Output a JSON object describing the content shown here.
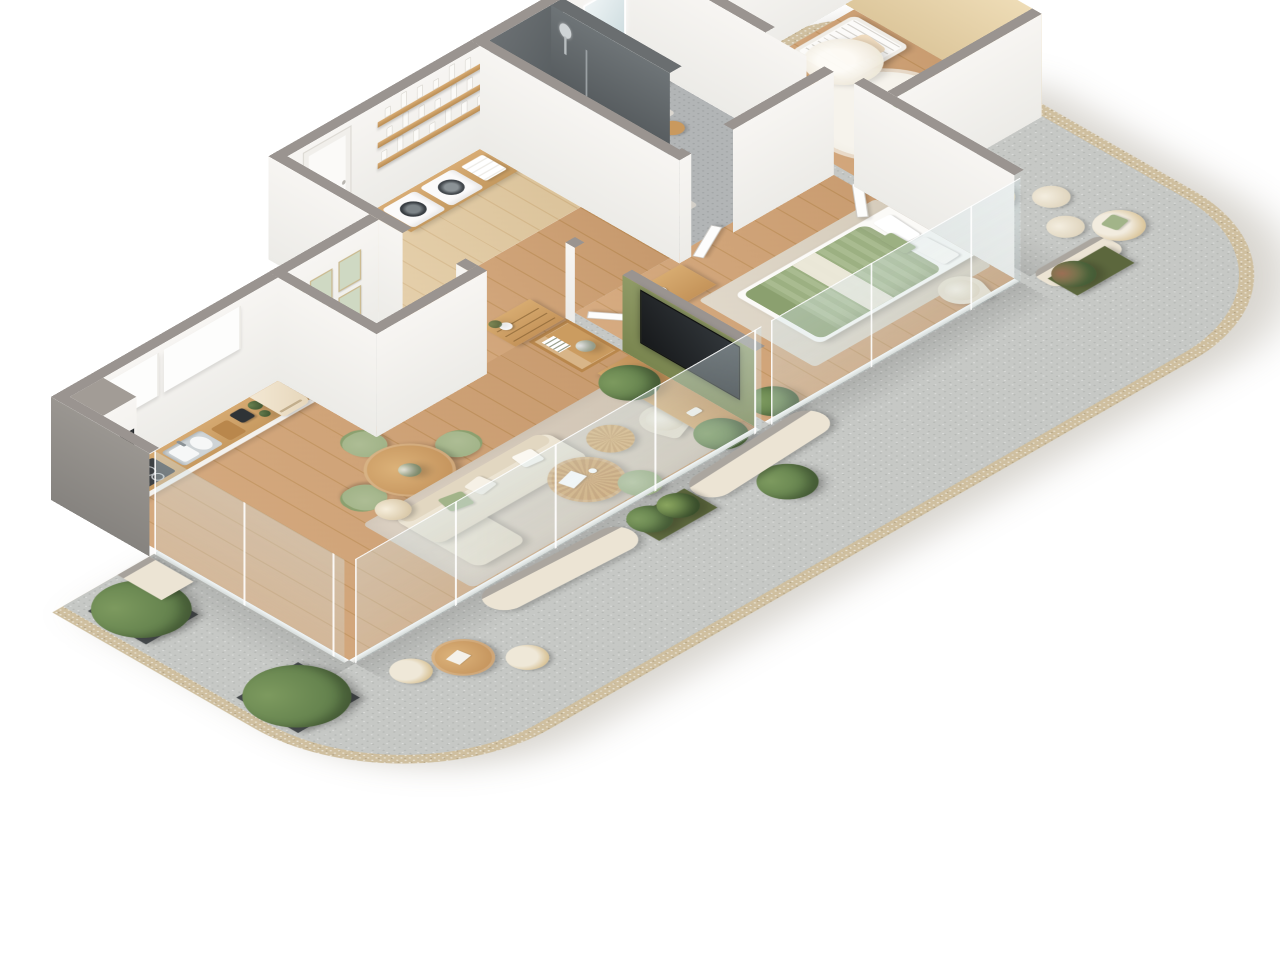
{
  "meta": {
    "type": "isometric-floorplan-render",
    "style": "scandinavian-apartment",
    "background": "#ffffff"
  },
  "colors": {
    "wall_top": "#9a9490",
    "wall_face": "#f7f5f2",
    "wall_shade": "#ecebe7",
    "wood_floor": "#d2a273",
    "wood_floor_dark": "#c4935c",
    "wood_pale": "#e4cba1",
    "wood_pale_dark": "#d9bb8c",
    "wood_counter": "#cda26c",
    "wood_furn": "#c9995e",
    "wood_furn_dark": "#b9874c",
    "dark_wall": "#5f6467",
    "dark_wall_light": "#71777a",
    "concrete": "#c6c8c5",
    "concrete_dark": "#b2b5b6",
    "railing": "#cfbf9f",
    "railing_dark": "#bfae8c",
    "cream": "#ede5d5",
    "cream_dark": "#ddd2bd",
    "sage": "#a2b489",
    "sage_dark": "#8ba06f",
    "olive": "#87925f",
    "beige_wall": "#e9d6ae",
    "plant": "#5f7d4a",
    "plant_light": "#7d9a5f",
    "planter_dark": "#45494b",
    "planter_olive": "#5c673d",
    "tan": "#d8c193",
    "glassc": "#cbdde1",
    "appl_dark": "#3c4043",
    "rug": "#d6cabb",
    "rug2": "#ddd5c7"
  },
  "apartment": {
    "rooms": [
      {
        "id": "entry",
        "furniture": [
          "front-door"
        ]
      },
      {
        "id": "laundry",
        "furniture": [
          "washer",
          "dryer",
          "wood-counter",
          "towel-stack",
          "wall-shelves-with-bottles"
        ]
      },
      {
        "id": "bathroom",
        "furniture": [
          "walk-in-shower",
          "glass-screen",
          "rain-shower-head",
          "slatted-cabinet",
          "vanity-with-basin",
          "led-mirror",
          "stool",
          "bath-mats"
        ]
      },
      {
        "id": "wc",
        "furniture": [
          "wall-hung-toilet",
          "gallery-frames",
          "magazine-ledge",
          "mat"
        ]
      },
      {
        "id": "kitchen",
        "furniture": [
          "tall-oven-column",
          "induction-cooktop",
          "double-sink",
          "cutting-board",
          "coffee-machine",
          "herb-pots",
          "retro-fridge",
          "upper-cabinets"
        ]
      },
      {
        "id": "dining",
        "furniture": [
          "round-table",
          "flower-vase",
          "sage-chairs"
        ]
      },
      {
        "id": "living-room",
        "furniture": [
          "corner-sofa",
          "sage-pillow",
          "dome-floor-lamp",
          "round-coffee-table-large",
          "round-coffee-table-small",
          "sage-pouf",
          "swivel-armchair",
          "area-rug",
          "tv-sideboard",
          "shelf-cube",
          "palm-plant",
          "monstera-plant"
        ]
      },
      {
        "id": "hallway",
        "furniture": [
          "chest-of-drawers",
          "vase"
        ]
      },
      {
        "id": "master-bedroom",
        "furniture": [
          "double-bed-sage-bedding",
          "pillows",
          "area-rug",
          "standing-mirror",
          "dresser",
          "armchair",
          "olive-tv-partition",
          "wall-tv",
          "plant"
        ]
      },
      {
        "id": "nursery",
        "furniture": [
          "crib-with-canopy",
          "round-shag-rug",
          "tripod-floor-lamp",
          "desk",
          "chair",
          "toys"
        ]
      },
      {
        "id": "balcony-west",
        "furniture": [
          "tree-planters",
          "bistro-table",
          "wicker-chairs",
          "round-bush-pot"
        ]
      },
      {
        "id": "balcony-south",
        "furniture": [
          "curved-parapet-walls",
          "olive-planter-boxes",
          "perforated-railing"
        ]
      },
      {
        "id": "balcony-east",
        "furniture": [
          "wicker-lounge-chairs",
          "poufs",
          "large-planter-bush",
          "olive-planter-box"
        ]
      }
    ]
  },
  "decor": {
    "laundry_shelves": 3,
    "bottles_per_shelf": 7,
    "gallery_rows": 2,
    "gallery_cols": 3,
    "dining_chairs": 4,
    "wall_height_px": 150,
    "partition_height_px": 110
  }
}
